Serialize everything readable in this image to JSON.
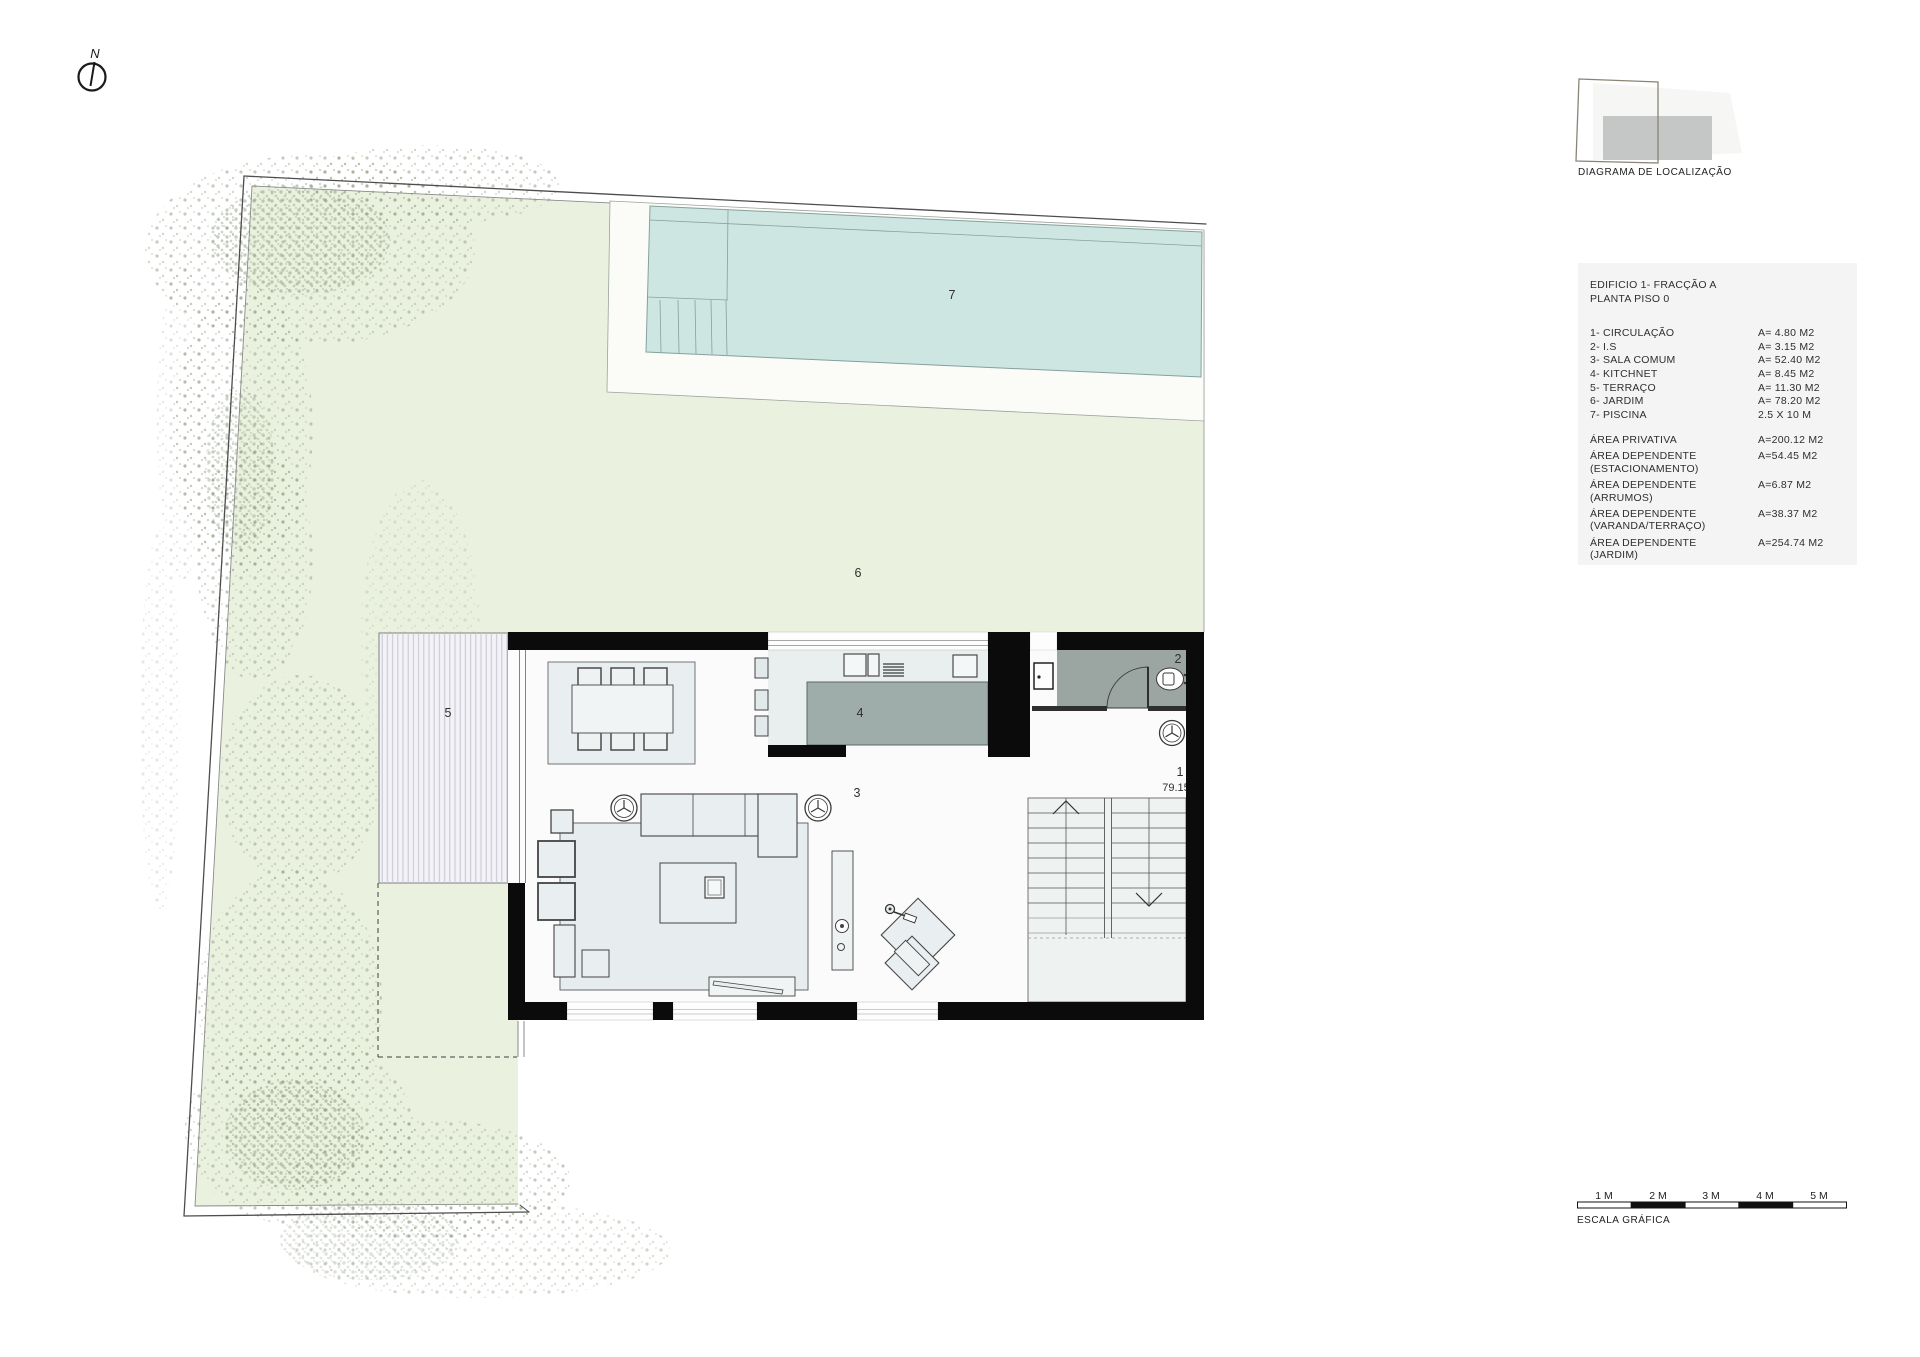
{
  "north": {
    "label": "N"
  },
  "location_diagram": {
    "caption": "DIAGRAMA DE LOCALIZAÇÃO"
  },
  "plan_labels": {
    "circulation": "1",
    "wc": "2",
    "living": "3",
    "kitchen": "4",
    "terrace": "5",
    "garden": "6",
    "pool": "7",
    "level": "79.15"
  },
  "legend": {
    "title_line1": "EDIFICIO 1- FRACÇÃO A",
    "title_line2": "PLANTA PISO 0",
    "rooms": [
      {
        "name": "1- CIRCULAÇÃO",
        "area": "A=  4.80 M2"
      },
      {
        "name": "2- I.S",
        "area": "A=  3.15 M2"
      },
      {
        "name": "3- SALA COMUM",
        "area": "A=  52.40 M2"
      },
      {
        "name": "4- KITCHNET",
        "area": "A=  8.45 M2"
      },
      {
        "name": "5- TERRAÇO",
        "area": "A=  11.30 M2"
      },
      {
        "name": "6- JARDIM",
        "area": "A=  78.20 M2"
      },
      {
        "name": "7- PISCINA",
        "area": "2.5 X 10 M"
      }
    ],
    "areas": [
      {
        "name": "ÁREA PRIVATIVA",
        "sub": "",
        "value": "A=200.12 M2"
      },
      {
        "name": "ÁREA DEPENDENTE",
        "sub": "(ESTACIONAMENTO)",
        "value": "A=54.45 M2"
      },
      {
        "name": "ÁREA DEPENDENTE",
        "sub": "(ARRUMOS)",
        "value": "A=6.87 M2"
      },
      {
        "name": "ÁREA DEPENDENTE",
        "sub": "(VARANDA/TERRAÇO)",
        "value": "A=38.37 M2"
      },
      {
        "name": "ÁREA DEPENDENTE",
        "sub": "(JARDIM)",
        "value": "A=254.74 M2"
      }
    ]
  },
  "scale_bar": {
    "caption": "ESCALA GRÁFICA",
    "ticks": [
      "1 M",
      "2 M",
      "3 M",
      "4 M",
      "5 M"
    ]
  },
  "colors": {
    "wall": "#0b0b0b",
    "pool_water": "#cee6e2",
    "garden": "#eaf2df",
    "deck": "#fbfcf8",
    "bathroom": "#9ba6a3",
    "counter": "#9fadaa",
    "terrace": "#f3f2f6"
  }
}
